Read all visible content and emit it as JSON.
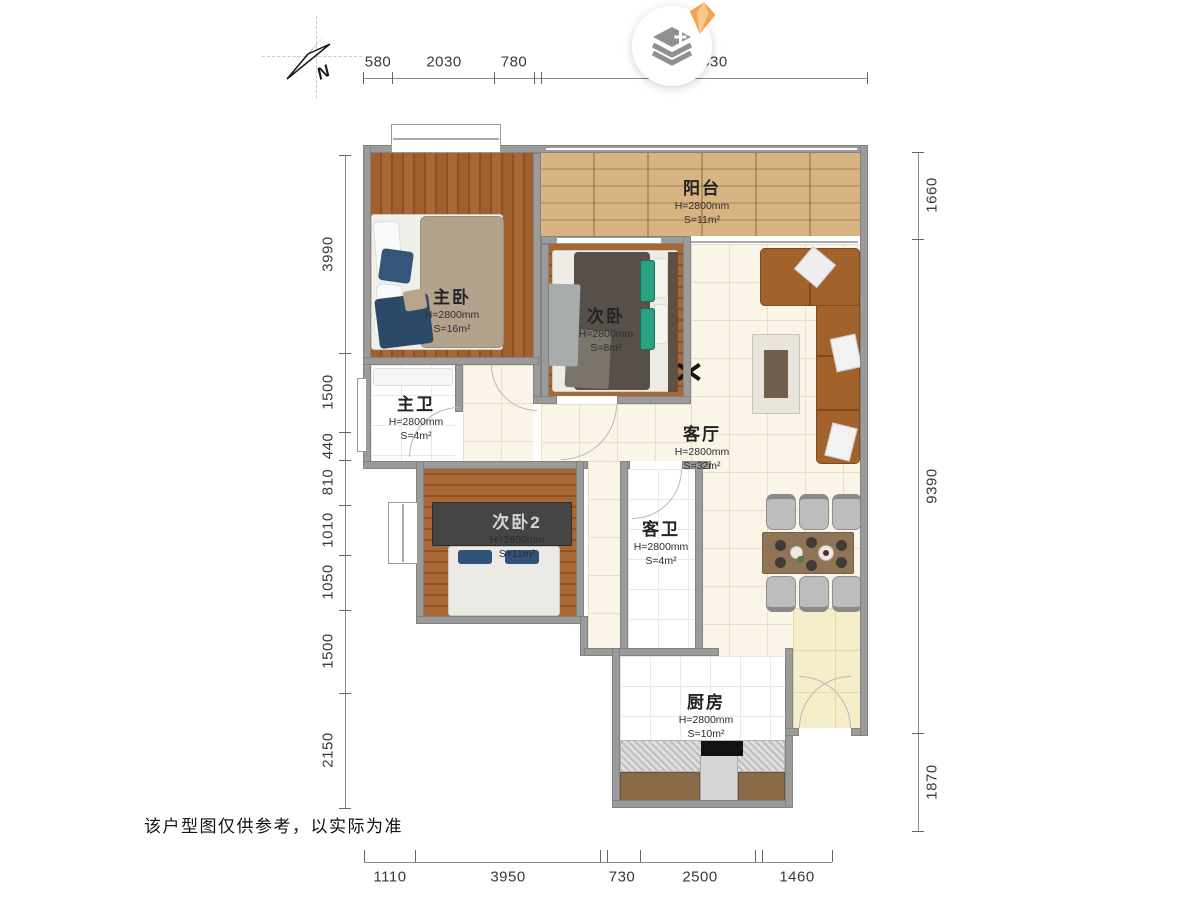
{
  "title": "户型图",
  "disclaimer": "该户型图仅供参考，以实际为准",
  "compass": {
    "label": "N"
  },
  "badge": {
    "icon": "layers-plus-icon",
    "gem": "gem-icon"
  },
  "rooms": [
    {
      "id": "balcony",
      "name": "阳台",
      "height": "H=2800mm",
      "area": "S=11m²"
    },
    {
      "id": "master-bedroom",
      "name": "主卧",
      "height": "H=2800mm",
      "area": "S=16m²"
    },
    {
      "id": "bedroom",
      "name": "次卧",
      "height": "H=2800mm",
      "area": "S=8m²"
    },
    {
      "id": "master-bath",
      "name": "主卫",
      "height": "H=2800mm",
      "area": "S=4m²"
    },
    {
      "id": "living-room",
      "name": "客厅",
      "height": "H=2800mm",
      "area": "S=32m²"
    },
    {
      "id": "bedroom-2",
      "name": "次卧2",
      "height": "H=2800mm",
      "area": "S=11m²"
    },
    {
      "id": "guest-bath",
      "name": "客卫",
      "height": "H=2800mm",
      "area": "S=4m²"
    },
    {
      "id": "kitchen",
      "name": "厨房",
      "height": "H=2800mm",
      "area": "S=10m²"
    }
  ],
  "dims": {
    "top": [
      "580",
      "2030",
      "780",
      "6530"
    ],
    "left": [
      "3990",
      "1500",
      "440",
      "810",
      "1010",
      "1050",
      "1500",
      "2150"
    ],
    "right": [
      "1660",
      "9390",
      "1870"
    ],
    "bottom": [
      "1110",
      "3950",
      "730",
      "2500",
      "1460"
    ]
  },
  "colors": {
    "wall": "#9b9b9b",
    "wood": "#a05f2c",
    "wood_dark": "#8e5024",
    "balcony": "#d8b483",
    "cream": "#faf5e6",
    "yellow_tile": "#f6eecb",
    "sofa": "#a2622c",
    "dining": "#8f7457",
    "chair": "#bdbdbd",
    "green": "#2aa183",
    "navy": "#2c4a67",
    "tan": "#b3a28c",
    "gem": "#f3a44f",
    "icon_gray": "#909090",
    "dim": "#3a3a3a"
  }
}
